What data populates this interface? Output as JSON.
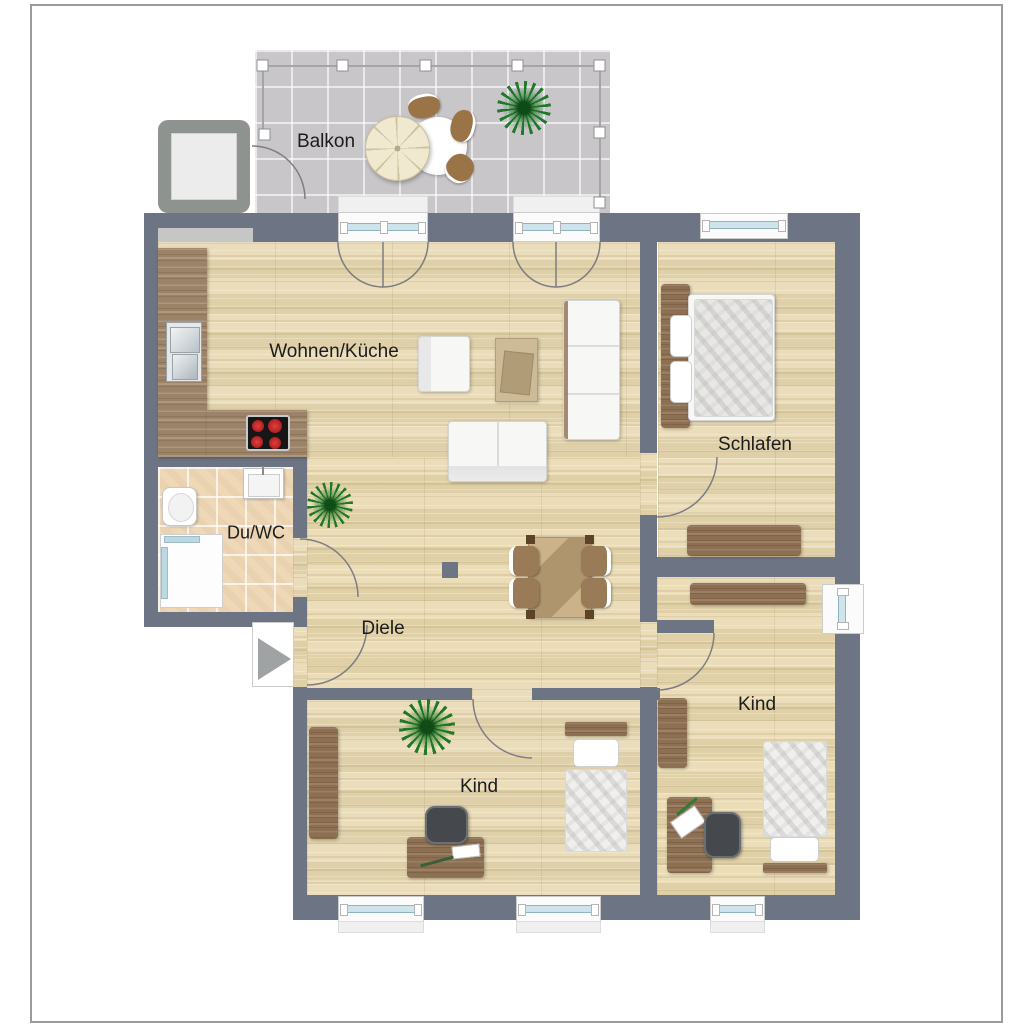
{
  "floorplan": {
    "type": "apartment-floor-plan",
    "labels": {
      "balcony": "Balkon",
      "living_kitchen": "Wohnen/Küche",
      "bedroom": "Schlafen",
      "bathroom": "Du/WC",
      "hallway": "Diele",
      "child_room_left": "Kind",
      "child_room_right": "Kind"
    },
    "colors": {
      "wall": "#6d7483",
      "wood_floor": "#e5d6b0",
      "bathroom_tile": "#eed8b8",
      "balcony_tile": "#c9c6ca",
      "kitchen_counter": "#9c8367",
      "furniture_wood": "#8d6f52",
      "window_glass": "#cfe4ea",
      "stove_burner": "#c32222",
      "plant_green": "#1e7a26",
      "entrance_arrow": "#a0a3a4"
    },
    "furniture": {
      "balcony": [
        "patio-table",
        "patio-chair",
        "parasol",
        "potted-plant"
      ],
      "living_kitchen": [
        "kitchen-counter",
        "kitchen-sink",
        "stove",
        "armchair",
        "coffee-table",
        "sofa",
        "loveseat",
        "dining-table",
        "dining-chair",
        "potted-plant",
        "column"
      ],
      "bedroom": [
        "double-bed",
        "sideboard"
      ],
      "bathroom": [
        "toilet",
        "washbasin",
        "shower"
      ],
      "child_room_left": [
        "wardrobe",
        "desk",
        "office-chair",
        "single-bed",
        "potted-plant"
      ],
      "child_room_right": [
        "sideboard",
        "shelf",
        "desk",
        "office-chair",
        "single-bed"
      ]
    }
  }
}
